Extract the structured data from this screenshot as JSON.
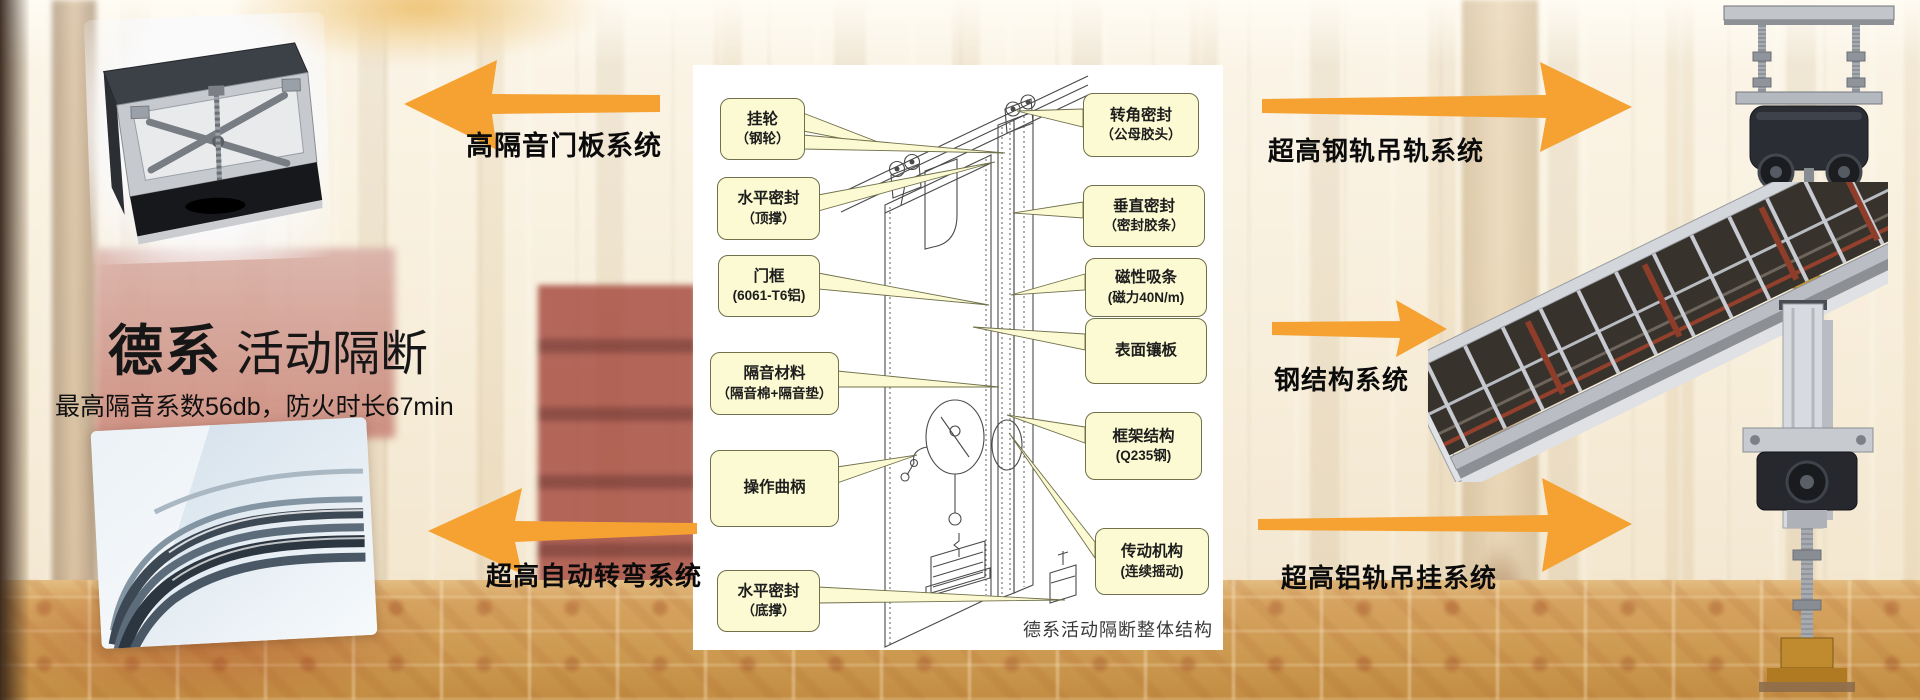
{
  "hero": {
    "title_bold": "德系",
    "title_light": "活动隔断",
    "subtitle": "最高隔音系数56db，防火时长67min"
  },
  "feature_labels": {
    "door_panel": "高隔音门板系统",
    "auto_turn": "超高自动转弯系统",
    "steel_rail": "超高钢轨吊轨系统",
    "steel_structure": "钢结构系统",
    "alu_rail": "超高铝轨吊挂系统"
  },
  "diagram": {
    "caption": "德系活动隔断整体结构",
    "callouts_left": [
      {
        "line1": "挂轮",
        "line2": "（钢轮）"
      },
      {
        "line1": "水平密封",
        "line2": "（顶撑）"
      },
      {
        "line1": "门框",
        "line2": "(6061-T6铝)"
      },
      {
        "line1": "隔音材料",
        "line2": "（隔音棉+隔音垫）"
      },
      {
        "line1": "操作曲柄",
        "line2": ""
      },
      {
        "line1": "水平密封",
        "line2": "（底撑）"
      }
    ],
    "callouts_right": [
      {
        "line1": "转角密封",
        "line2": "（公母胶头）"
      },
      {
        "line1": "垂直密封",
        "line2": "（密封胶条）"
      },
      {
        "line1": "磁性吸条",
        "line2": "(磁力40N/m)"
      },
      {
        "line1": "表面镶板",
        "line2": ""
      },
      {
        "line1": "框架结构",
        "line2": "(Q235钢)"
      },
      {
        "line1": "传动机构",
        "line2": "(连续摇动)"
      }
    ]
  },
  "colors": {
    "arrow": "#F5A233",
    "callout_fill": "#FCFAD2",
    "callout_border": "#70704C"
  }
}
